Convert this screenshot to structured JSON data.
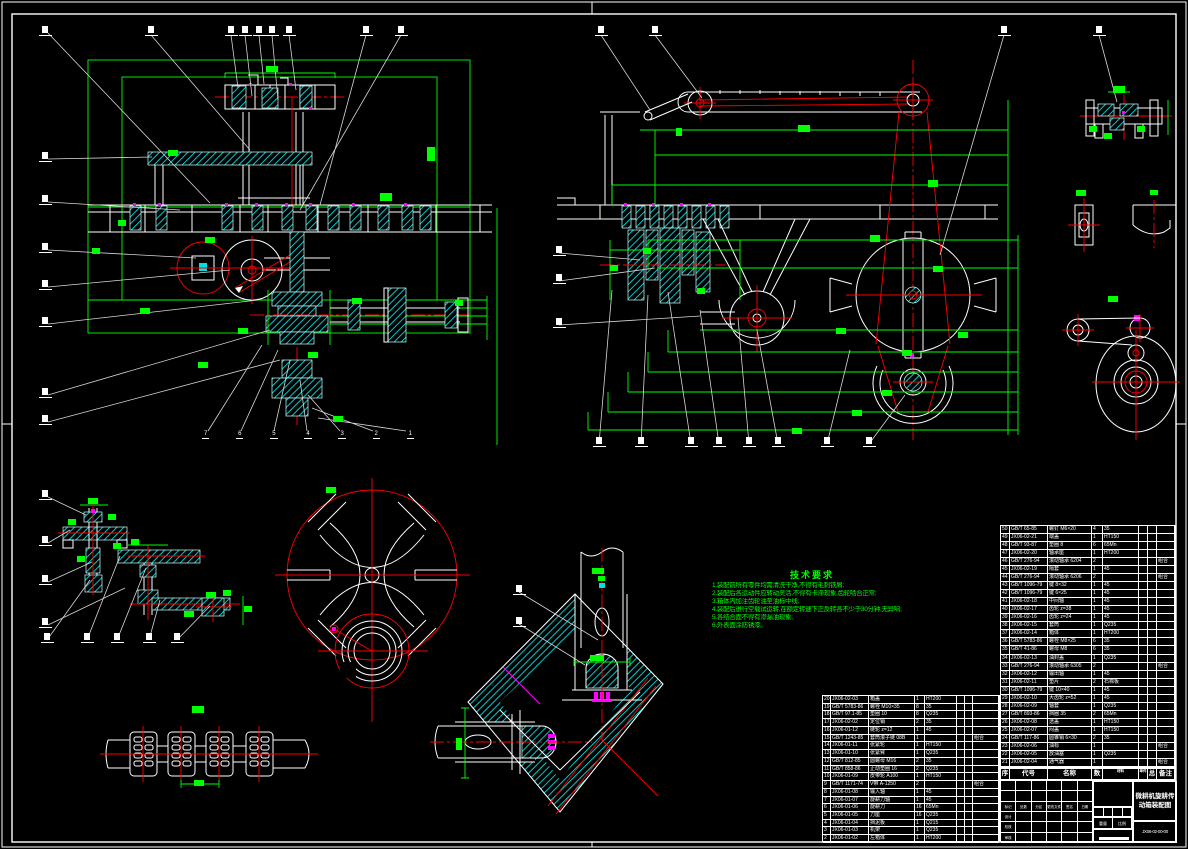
{
  "sheet": {
    "background": "#000000",
    "frame_color": "#ffffff"
  },
  "colors": {
    "dimension": "#00ff00",
    "centerline": "#ff0000",
    "hatch": "#00e0e0",
    "outline": "#ffffff",
    "leader": "#d8d8d8",
    "detail": "#ff00ff"
  },
  "callouts": {
    "bottom_numbers": [
      {
        "n": "7"
      },
      {
        "n": "6"
      },
      {
        "n": "5"
      },
      {
        "n": "4"
      },
      {
        "n": "3"
      },
      {
        "n": "2"
      },
      {
        "n": "1"
      }
    ]
  },
  "tech_requirements": {
    "title": "技术要求",
    "lines": [
      {
        "text": "1.装配前所有零件均需清洗干净,不得有毛刺铁屑;"
      },
      {
        "text": "2.装配后各运动件应转动灵活,不得有卡滞现象,齿轮啮合正常;"
      },
      {
        "text": "3.箱体内加注齿轮油至油标中线;"
      },
      {
        "text": "4.装配后进行空载试运转,在额定转速下正反转各不少于30分钟,无异响;"
      },
      {
        "text": "5.各结合面不得有渗漏油现象;"
      },
      {
        "text": "6.外表面涂防锈漆。"
      }
    ]
  },
  "bom_header": {
    "cols": [
      {
        "t": "序"
      },
      {
        "t": "代号"
      },
      {
        "t": "名称"
      },
      {
        "t": "数"
      },
      {
        "t": "材料"
      },
      {
        "t": "单件"
      },
      {
        "t": "总计"
      },
      {
        "t": "备注"
      }
    ]
  },
  "bom_right": {
    "rows": [
      [
        "50",
        "GB/T 65-85",
        "螺钉 M6×20",
        "4",
        "35",
        "",
        "",
        ""
      ],
      [
        "49",
        "JX06-02-21",
        "端盖",
        "1",
        "HT150",
        "",
        "",
        ""
      ],
      [
        "48",
        "GB/T 93-87",
        "垫圈 8",
        "6",
        "65Mn",
        "",
        "",
        ""
      ],
      [
        "47",
        "JX06-02-20",
        "轴承座",
        "1",
        "HT200",
        "",
        "",
        ""
      ],
      [
        "46",
        "GB/T 276-94",
        "滚动轴承 6204",
        "2",
        "",
        "",
        "",
        "组合"
      ],
      [
        "45",
        "JX06-02-19",
        "隔套",
        "1",
        "45",
        "",
        "",
        ""
      ],
      [
        "44",
        "GB/T 276-94",
        "滚动轴承 6206",
        "2",
        "",
        "",
        "",
        "组合"
      ],
      [
        "43",
        "GB/T 1096-79",
        "键 8×32",
        "1",
        "45",
        "",
        "",
        ""
      ],
      [
        "42",
        "GB/T 1096-79",
        "键 6×25",
        "1",
        "45",
        "",
        "",
        ""
      ],
      [
        "41",
        "JX06-02-18",
        "中间轴",
        "1",
        "45",
        "",
        "",
        ""
      ],
      [
        "40",
        "JX06-02-17",
        "齿轮 z=38",
        "1",
        "45",
        "",
        "",
        ""
      ],
      [
        "39",
        "JX06-02-16",
        "齿轮 z=24",
        "1",
        "45",
        "",
        "",
        ""
      ],
      [
        "38",
        "JX06-02-15",
        "套筒",
        "1",
        "Q235",
        "",
        "",
        ""
      ],
      [
        "37",
        "JX06-02-14",
        "箱体",
        "1",
        "HT200",
        "",
        "",
        ""
      ],
      [
        "36",
        "GB/T 5783-86",
        "螺栓 M8×25",
        "6",
        "35",
        "",
        "",
        ""
      ],
      [
        "35",
        "GB/T 41-86",
        "螺母 M8",
        "6",
        "35",
        "",
        "",
        ""
      ],
      [
        "34",
        "JX06-02-13",
        "油封盖",
        "1",
        "Q235",
        "",
        "",
        ""
      ],
      [
        "33",
        "GB/T 276-94",
        "滚动轴承 6305",
        "2",
        "",
        "",
        "",
        "组合"
      ],
      [
        "32",
        "JX06-02-12",
        "输出轴",
        "1",
        "45",
        "",
        "",
        ""
      ],
      [
        "31",
        "JX06-02-11",
        "垫片",
        "2",
        "石棉板",
        "",
        "",
        ""
      ],
      [
        "30",
        "GB/T 1096-79",
        "键 10×40",
        "1",
        "45",
        "",
        "",
        ""
      ],
      [
        "29",
        "JX06-02-10",
        "大齿轮 z=52",
        "1",
        "45",
        "",
        "",
        ""
      ],
      [
        "28",
        "JX06-02-09",
        "轴套",
        "1",
        "Q235",
        "",
        "",
        ""
      ],
      [
        "27",
        "GB/T 893-86",
        "挡圈 35",
        "2",
        "65Mn",
        "",
        "",
        ""
      ],
      [
        "26",
        "JX06-02-08",
        "透盖",
        "1",
        "HT150",
        "",
        "",
        ""
      ],
      [
        "25",
        "JX06-02-07",
        "闷盖",
        "1",
        "HT150",
        "",
        "",
        ""
      ],
      [
        "24",
        "GB/T 117-86",
        "圆锥销 6×30",
        "2",
        "35",
        "",
        "",
        ""
      ],
      [
        "23",
        "JX06-02-06",
        "油标",
        "1",
        "",
        "",
        "",
        "组合"
      ],
      [
        "22",
        "JX06-02-05",
        "放油塞",
        "1",
        "Q235",
        "",
        "",
        ""
      ],
      [
        "21",
        "JX06-02-04",
        "通气器",
        "1",
        "",
        "",
        "",
        "组合"
      ]
    ]
  },
  "bom_left": {
    "rows": [
      [
        "20",
        "JX06-02-03",
        "箱盖",
        "1",
        "HT200",
        "",
        "",
        ""
      ],
      [
        "19",
        "GB/T 5783-86",
        "螺栓 M10×35",
        "8",
        "35",
        "",
        "",
        ""
      ],
      [
        "18",
        "GB/T 97.1-85",
        "垫圈 10",
        "8",
        "Q235",
        "",
        "",
        ""
      ],
      [
        "17",
        "JX06-02-02",
        "定位销",
        "2",
        "35",
        "",
        "",
        ""
      ],
      [
        "16",
        "JX06-01-12",
        "链轮 z=12",
        "1",
        "45",
        "",
        "",
        ""
      ],
      [
        "15",
        "GB/T 1243-85",
        "套筒滚子链 08B",
        "1",
        "",
        "",
        "",
        "组合"
      ],
      [
        "14",
        "JX06-01-11",
        "张紧轮",
        "1",
        "HT150",
        "",
        "",
        ""
      ],
      [
        "13",
        "JX06-01-10",
        "张紧臂",
        "1",
        "Q235",
        "",
        "",
        ""
      ],
      [
        "12",
        "GB/T 812-85",
        "圆螺母 M16",
        "2",
        "35",
        "",
        "",
        ""
      ],
      [
        "11",
        "GB/T 858-86",
        "止动垫圈 16",
        "2",
        "Q235",
        "",
        "",
        ""
      ],
      [
        "10",
        "JX06-01-09",
        "皮带轮 A100",
        "1",
        "HT150",
        "",
        "",
        ""
      ],
      [
        "9",
        "GB/T 1171-74",
        "V带 A-1250",
        "2",
        "",
        "",
        "",
        "组合"
      ],
      [
        "8",
        "JX06-01-08",
        "输入轴",
        "1",
        "45",
        "",
        "",
        ""
      ],
      [
        "7",
        "JX06-01-07",
        "旋耕刀轴",
        "1",
        "45",
        "",
        "",
        ""
      ],
      [
        "6",
        "JX06-01-06",
        "旋耕刀",
        "16",
        "65Mn",
        "",
        "",
        ""
      ],
      [
        "5",
        "JX06-01-05",
        "刀座",
        "16",
        "Q235",
        "",
        "",
        ""
      ],
      [
        "4",
        "JX06-01-04",
        "挡泥板",
        "1",
        "Q215",
        "",
        "",
        ""
      ],
      [
        "3",
        "JX06-01-03",
        "机架",
        "1",
        "Q235",
        "",
        "",
        ""
      ],
      [
        "2",
        "JX06-01-02",
        "左箱体",
        "1",
        "HT200",
        "",
        "",
        ""
      ]
    ]
  },
  "title_block": {
    "product_title": "微耕机旋耕传动箱装配图",
    "drawing_no": "JX06-02-00-00",
    "weight_label": "重量",
    "scale_label": "比例",
    "sig_cells": [
      "",
      "",
      "",
      "",
      "",
      "",
      "",
      "",
      "",
      "",
      "",
      "",
      "标记",
      "处数",
      "分区",
      "更改文件号",
      "签名",
      "日期",
      "设计",
      "",
      "",
      "",
      "",
      "",
      "校核",
      "",
      "",
      "",
      "",
      "",
      "审核",
      "",
      "",
      "",
      "",
      ""
    ]
  }
}
